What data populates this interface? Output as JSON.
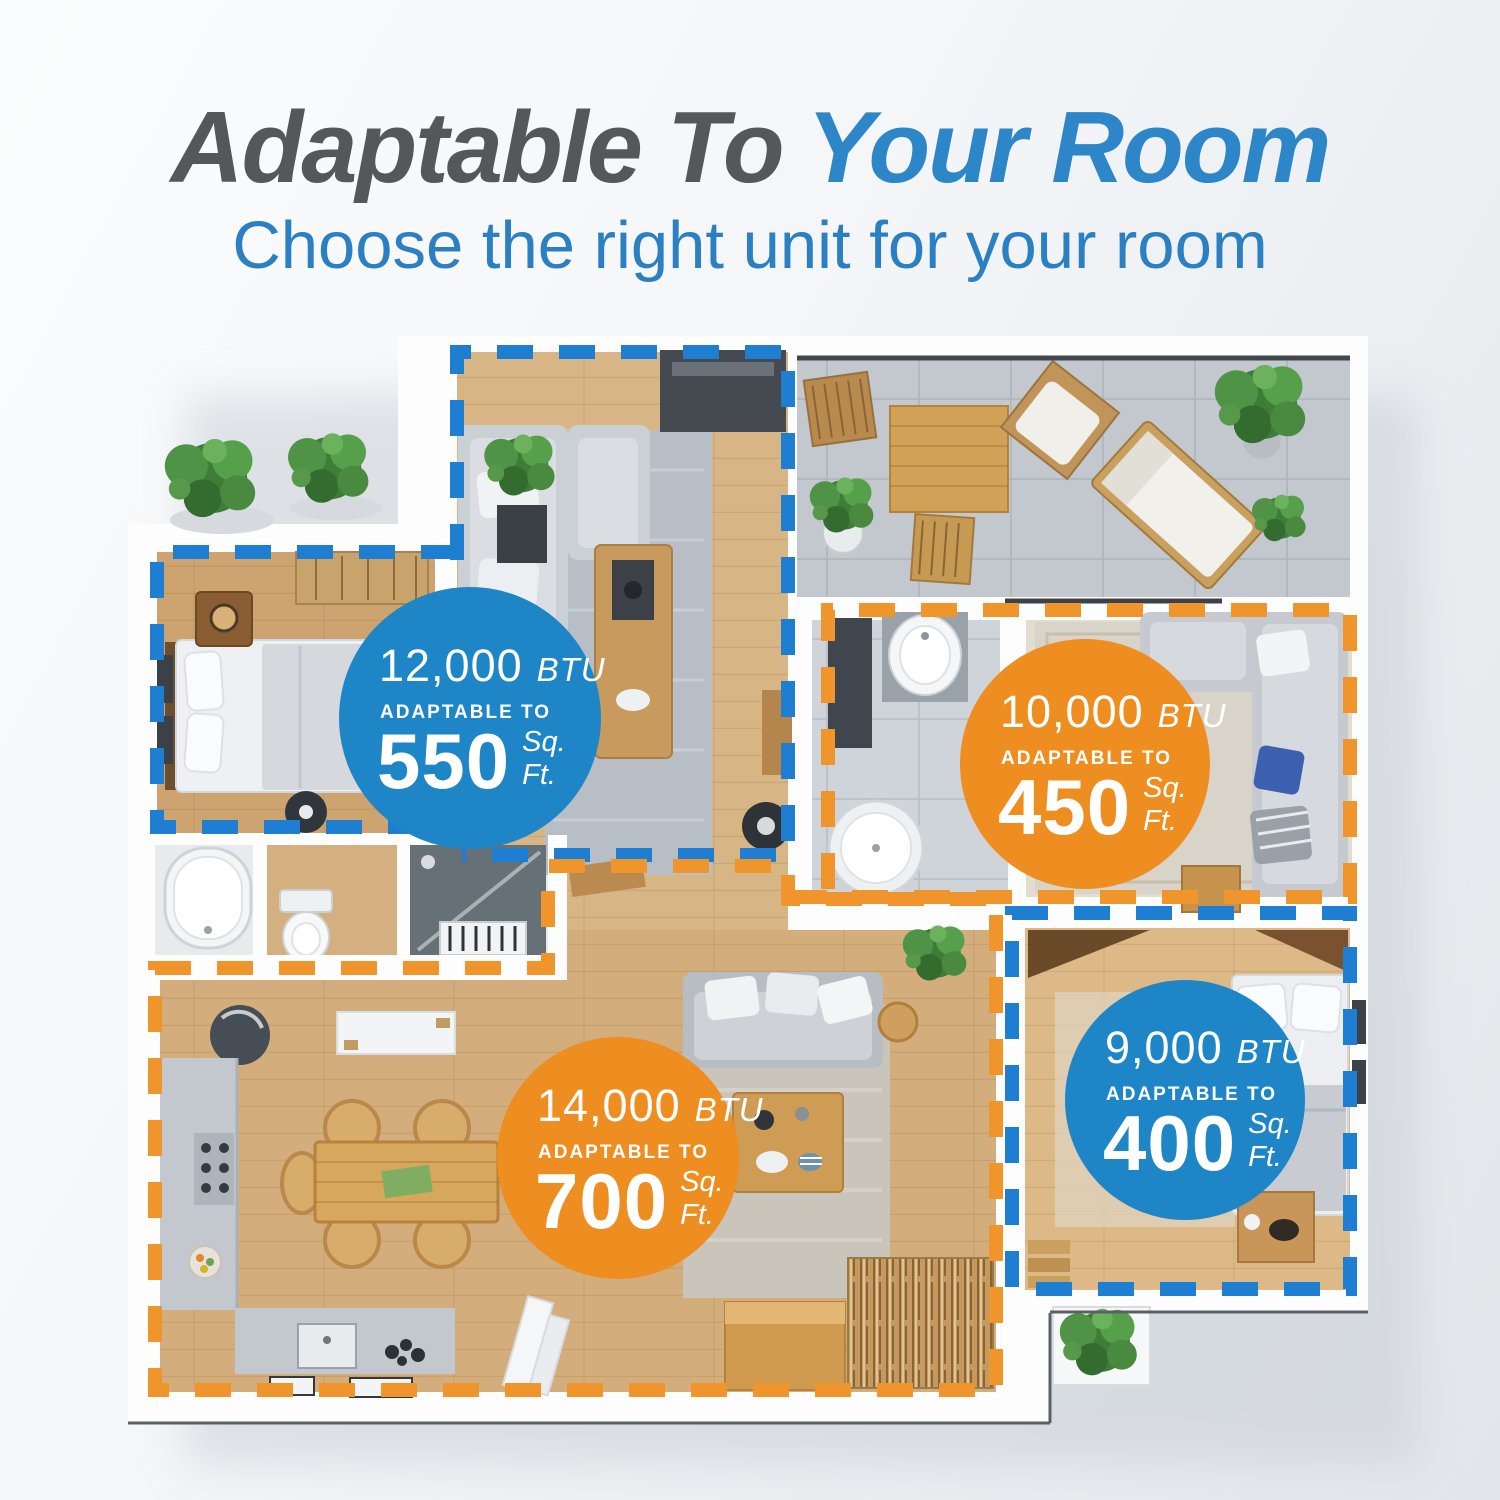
{
  "header": {
    "title_dark": "Adaptable To ",
    "title_accent": "Your Room",
    "subtitle": "Choose the right unit for your room"
  },
  "floor_plan": {
    "description": "apartment floor plan top view with four unit-coverage zones",
    "zones": [
      {
        "name": "living-room-and-bedroom",
        "dash_color": "#1d7ed2",
        "badge": "12,000 BTU"
      },
      {
        "name": "bathroom-and-lounge",
        "dash_color": "#f0952b",
        "badge": "10,000 BTU"
      },
      {
        "name": "kitchen-dining-living",
        "dash_color": "#f0952b",
        "badge": "14,000 BTU"
      },
      {
        "name": "second-bedroom",
        "dash_color": "#1d7ed2",
        "badge": "9,000 BTU"
      }
    ],
    "badges": [
      {
        "btu_value": "12,000",
        "btu_unit": "BTU",
        "adaptable_label": "ADAPTABLE TO",
        "sqft_value": "550",
        "sqft_unit": "Sq. Ft.",
        "circle_color": "#1e86c7"
      },
      {
        "btu_value": "10,000",
        "btu_unit": "BTU",
        "adaptable_label": "ADAPTABLE TO",
        "sqft_value": "450",
        "sqft_unit": "Sq. Ft.",
        "circle_color": "#ee8d20"
      },
      {
        "btu_value": "14,000",
        "btu_unit": "BTU",
        "adaptable_label": "ADAPTABLE TO",
        "sqft_value": "700",
        "sqft_unit": "Sq. Ft.",
        "circle_color": "#ee8d20"
      },
      {
        "btu_value": "9,000",
        "btu_unit": "BTU",
        "adaptable_label": "ADAPTABLE TO",
        "sqft_value": "400",
        "sqft_unit": "Sq. Ft.",
        "circle_color": "#1e86c7"
      }
    ]
  },
  "colors": {
    "title_dark": "#55575b",
    "title_accent": "#2d86c8",
    "subtitle_blue": "#2a80c2",
    "badge_blue": "#1e86c7",
    "badge_orange": "#ee8d20",
    "dash_blue": "#1d7ed2",
    "dash_orange": "#f0952b"
  }
}
